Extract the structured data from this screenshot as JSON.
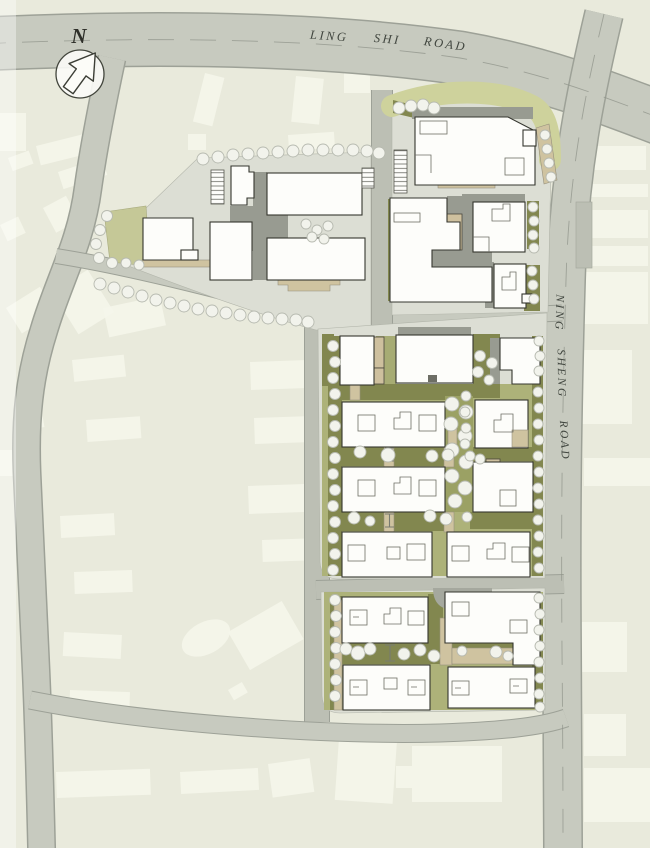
{
  "map": {
    "north_label": "N",
    "roads": {
      "ling_shi": {
        "words": [
          "LING",
          "SHI",
          "ROAD"
        ]
      },
      "ning_sheng": {
        "words": [
          "NING",
          "SHENG",
          "ROAD"
        ]
      }
    },
    "colors": {
      "background": "#e9eadc",
      "road": "#c7cabf",
      "road_edge": "#9da197",
      "site_pavement": "#dcded4",
      "landscape_olive": "#a7ac74",
      "landscape_mid": "#adb279",
      "landscape_dark": "#82874f",
      "landscape_pale": "#ced29c",
      "path_tan": "#cfc3a0",
      "building_white": "#fdfdfa",
      "building_tan": "#cec09e",
      "building_outline": "#35362f",
      "shadow": "#989b91",
      "tree_fill": "#f2f3ec",
      "tree_edge": "#b7bab0",
      "context_building": "#f5f6ea",
      "label": "#41463f"
    }
  }
}
